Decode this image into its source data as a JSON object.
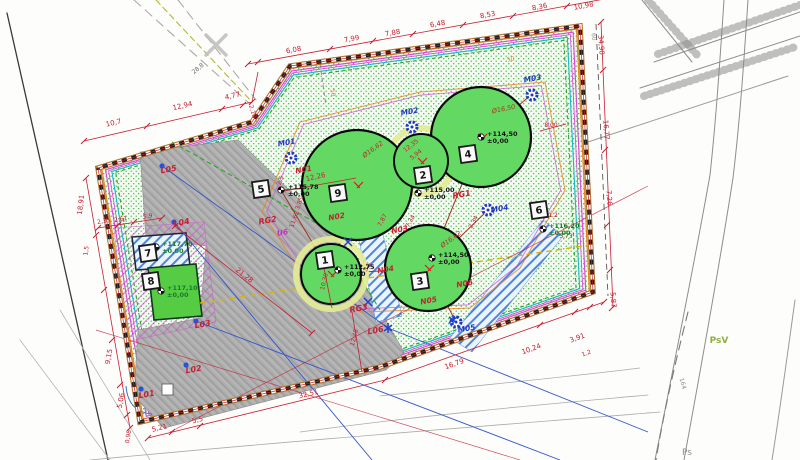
{
  "palette": {
    "dim_red": "#c52033",
    "label_blue": "#2038c0",
    "tank_green": "#63d963",
    "gray_area": "#ababab",
    "fence_brown": "#b0722e",
    "accent_magenta": "#d24fd2",
    "accent_orange": "#e8821e",
    "elev_green": "#1a7a2a"
  },
  "badges": {
    "b1": "1",
    "b2": "2",
    "b3": "3",
    "b4": "4",
    "b5": "5",
    "b6": "6",
    "b7": "7",
    "b8": "8",
    "b9": "9"
  },
  "elevations": {
    "e1": {
      "top": "+112,75",
      "bottom": "±0,00"
    },
    "e2": {
      "top": "+115,00",
      "bottom": "±0,00"
    },
    "e3": {
      "top": "+114,50",
      "bottom": "±0,00"
    },
    "e4": {
      "top": "+114,50",
      "bottom": "±0,00"
    },
    "e5": {
      "top": "+115,78",
      "bottom": "±0,00"
    },
    "e6": {
      "top": "+116,20",
      "bottom": "±0,00"
    },
    "e7": {
      "top": "+117,70",
      "bottom": "±0,00"
    },
    "e8": {
      "top": "+117,10",
      "bottom": "±0,00"
    }
  },
  "node_labels": {
    "n1": "N01",
    "n2": "N02",
    "n3": "N03",
    "n4": "N04",
    "n5": "N05",
    "n6": "N06"
  },
  "manhole_labels": {
    "m1": "M01",
    "m2": "M02",
    "m3": "M03",
    "m4": "M04",
    "m5": "M05"
  },
  "light_labels": {
    "l1": "L01",
    "l2": "L02",
    "l3": "L03",
    "l4": "L04",
    "l5": "L05",
    "l6": "L06"
  },
  "drain_labels": {
    "rg1": "RG1",
    "rg2": "RG2",
    "rg3": "RG3",
    "u6": "U6"
  },
  "diameters": {
    "tank9": "Ø16,62",
    "tank4": "Ø16,50",
    "tank3": "Ø16,62"
  },
  "dims": {
    "top": [
      "6,08",
      "7,99",
      "7,88",
      "6,48",
      "8,53",
      "8,36",
      "10,98"
    ],
    "top_left": [
      "10,7",
      "12,94",
      "4,77",
      "2,18"
    ],
    "left": [
      "18,91",
      "1,5",
      "9,15",
      "5,06",
      "0,98"
    ],
    "left_small": [
      "2,35",
      "2,61",
      "5,9"
    ],
    "right": [
      "34,90",
      "16,77",
      "7,26",
      "5,87"
    ],
    "bottom": [
      "5,21",
      "5,5",
      "32,51",
      "16,79",
      "10,24",
      "3,91",
      "1,2"
    ],
    "inner": [
      "12,26",
      "3,85",
      "11,62",
      "2,5",
      "12,35",
      "5,94",
      "8,00",
      "7,34",
      "7,87",
      "2,34",
      "21,28",
      "12,48",
      "10,30",
      "3,5",
      "1,2",
      "3,73"
    ],
    "small_orange": [
      "50",
      "50"
    ]
  },
  "outside": {
    "land_use": "PsV",
    "land_use2": "Ps",
    "parcel": "164",
    "mark": "28,8",
    "road": "60"
  }
}
